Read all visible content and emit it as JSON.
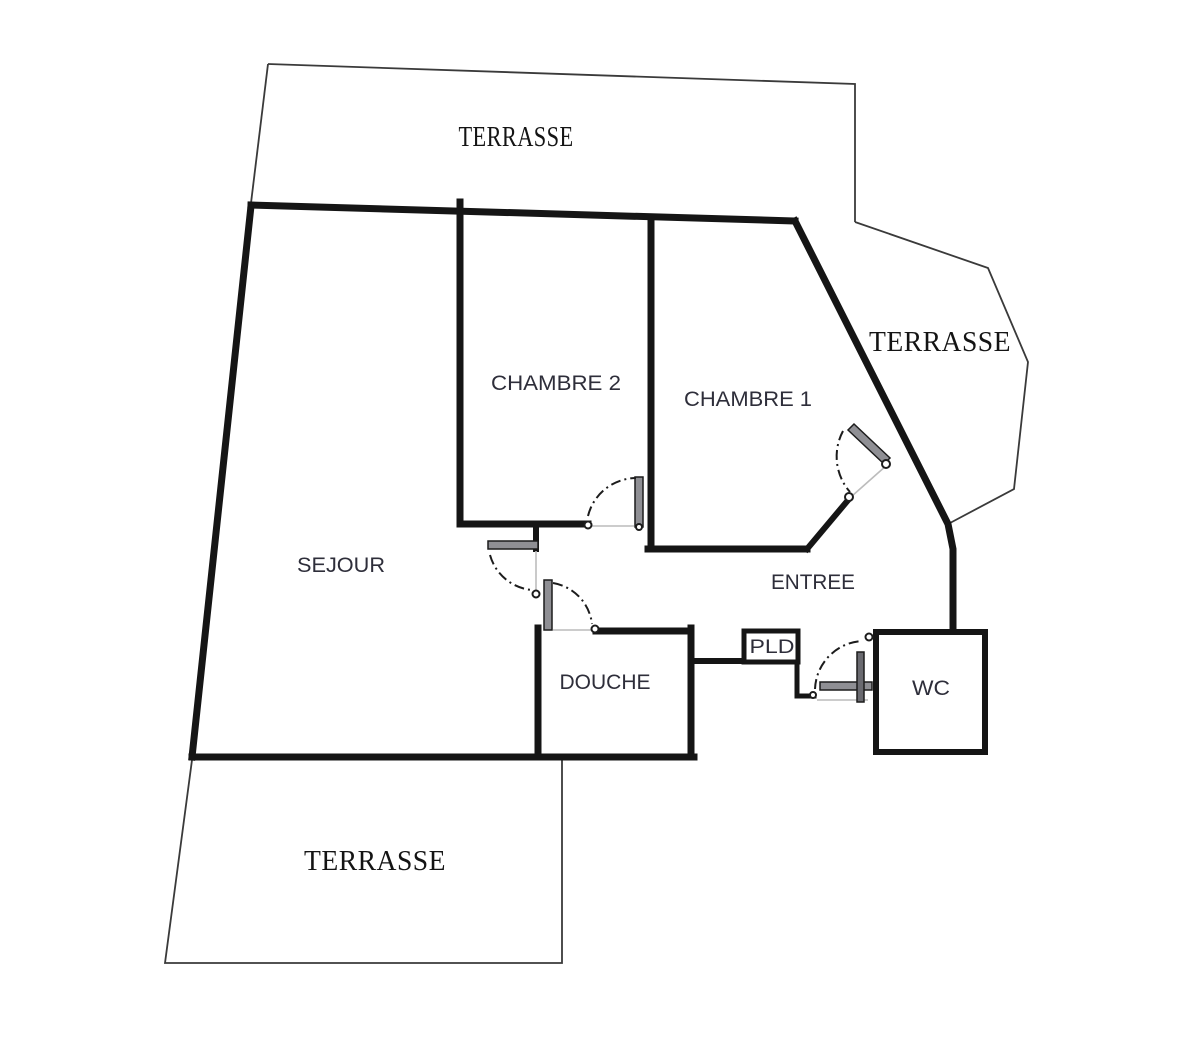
{
  "plan": {
    "background": "#ffffff",
    "wall_color": "#151515",
    "room_label_color": "#2e2e3a",
    "terrace_label_color": "#141414",
    "door_leaf_color": "#8f8f94",
    "rooms": [
      {
        "id": "terrasse-top",
        "label": "TERRASSE"
      },
      {
        "id": "sejour",
        "label": "SEJOUR"
      },
      {
        "id": "chambre-2",
        "label": "CHAMBRE 2"
      },
      {
        "id": "chambre-1",
        "label": "CHAMBRE 1"
      },
      {
        "id": "terrasse-right",
        "label": "TERRASSE"
      },
      {
        "id": "entree",
        "label": "ENTREE"
      },
      {
        "id": "douche",
        "label": "DOUCHE"
      },
      {
        "id": "pld",
        "label": "PLD"
      },
      {
        "id": "wc",
        "label": "WC"
      },
      {
        "id": "terrasse-bottom",
        "label": "TERRASSE"
      }
    ]
  }
}
